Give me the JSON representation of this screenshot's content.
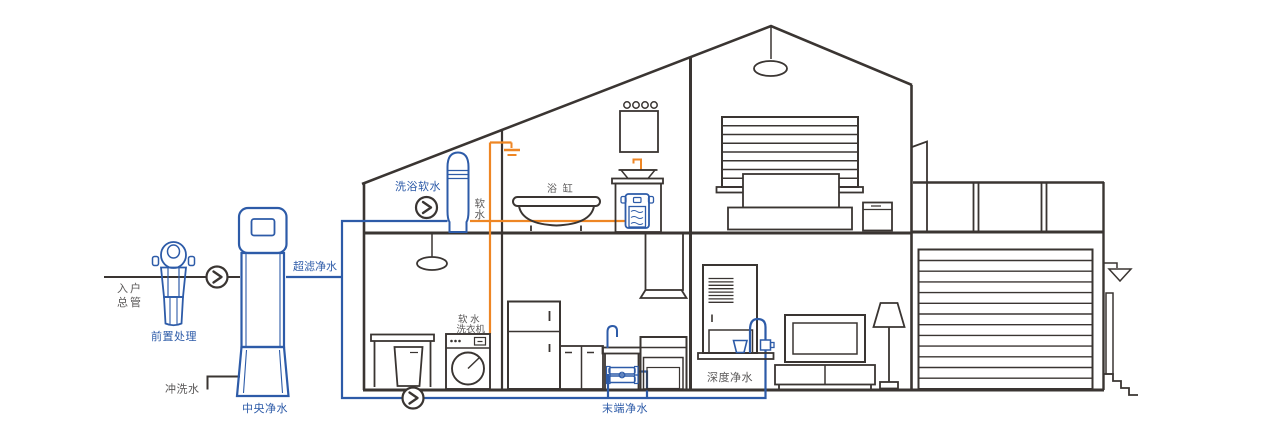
{
  "diagram": {
    "labels": {
      "incoming_main_line1": "入户",
      "incoming_main_line2": "总管",
      "pre_treatment": "前置处理",
      "flush_water": "冲洗水",
      "central_purifier": "中央净水",
      "ultrafiltration": "超滤净水",
      "bath_softener": "洗浴软水",
      "soft_water_char1": "软",
      "soft_water_char2": "水",
      "bathtub": "浴 缸",
      "soft_washer_line1": "软 水",
      "soft_washer_line2": "洗衣机",
      "terminal_purifier": "末端净水",
      "deep_purifier": "深度净水"
    },
    "colors": {
      "pipe_blue": "#2d5ba8",
      "pipe_orange": "#ee8624",
      "line_black": "#3a3532",
      "label_gray": "#595757",
      "label_blue": "#2d5ba8",
      "background": "#ffffff"
    }
  }
}
